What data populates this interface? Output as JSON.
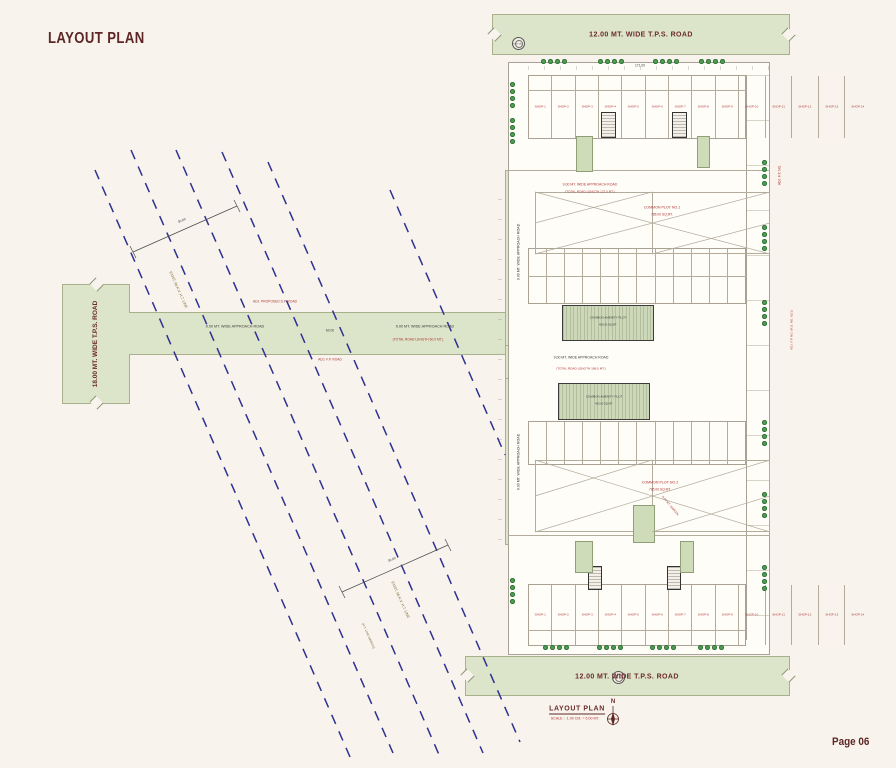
{
  "page": {
    "heading": "LAYOUT PLAN",
    "page_number": "Page 06"
  },
  "title_block": {
    "title": "LAYOUT PLAN",
    "scale": "SCALE :- 1.00 CM. = 5.00 MT.",
    "north_label": "N"
  },
  "roads": {
    "top_tps_road": "12.00 MT. WIDE T.P.S. ROAD",
    "bottom_tps_road": "12.00 MT. WIDE T.P.S. ROAD",
    "left_tps_road": "18.00 MT. WIDE T.P.S. ROAD",
    "approach_road_left": "9.00 MT. WIDE APPROACH ROAD",
    "approach_road_right": "9.00 MT. WIDE APPROACH ROAD",
    "approach_road_vertical_upper": "9.00 MT. WIDE APPROACH ROAD",
    "approach_road_vertical_lower": "9.00 MT. WIDE APPROACH ROAD",
    "approach_road_mid": "9.00 MT. WIDE APPROACH ROAD",
    "approach_road_top_note": "9.00 MT. WIDE APPROACH ROAD",
    "total_length_top": "(TOTAL ROAD LENGTH 127.0 MT.)",
    "total_length_mid": "(TOTAL ROAD LENGTH 186.0 MT.)",
    "total_length_main": "(TOTAL ROAD LENGTH 60.0 MT.)"
  },
  "dimensions": {
    "main_road_span": "60.00",
    "block_width": "171.00",
    "ht_span_1": "30.00",
    "ht_span_2": "30.00"
  },
  "annotations": {
    "adj_road_above": "ADJ. PROPOSED D.P. ROAD",
    "adj_fp_below": "ADJ. F.P. ROAD",
    "adj_fp_right_1": "ADJ. F.P. NO.",
    "adj_fp_right_2": "ADJ. F.P. NO. (R.S. NO. 81/1)",
    "ht_line_1": "EXIST. 66 K.V. H.T. LINE",
    "ht_line_2": "EXIST. 66 K.V. H.T. LINE",
    "ht_margin": "(H.T. LINE MARGIN)",
    "exist_well": "EXIST. WELL",
    "margin_note": "9.00 MT. MARGIN"
  },
  "common_plots": [
    {
      "name": "COMMON PLOT NO.1",
      "area": "785.00 SQ.MT."
    },
    {
      "name": "COMMON PLOT NO.2",
      "area": "785.00 SQ.MT."
    }
  ],
  "amenity_plots": [
    {
      "name": "COMMON AMENITY PLOT",
      "area": "450.00 SQ.MT."
    },
    {
      "name": "COMMON AMENITY PLOT",
      "area": "450.00 SQ.MT."
    }
  ],
  "shops_top": [
    "SHOP-1",
    "SHOP-2",
    "SHOP-3",
    "SHOP-4",
    "SHOP-5",
    "SHOP-6",
    "SHOP-7",
    "SHOP-8",
    "SHOP-9",
    "SHOP-10",
    "SHOP-11",
    "SHOP-12",
    "SHOP-13",
    "SHOP-14"
  ],
  "shops_bottom": [
    "SHOP-1",
    "SHOP-2",
    "SHOP-3",
    "SHOP-4",
    "SHOP-5",
    "SHOP-6",
    "SHOP-7",
    "SHOP-8",
    "SHOP-9",
    "SHOP-10",
    "SHOP-11",
    "SHOP-12",
    "SHOP-13",
    "SHOP-14"
  ],
  "colors": {
    "road_green": "#dce4c9",
    "tree_green": "#4f9d53",
    "maroon": "#5e2626",
    "label_red": "#b03535",
    "ht_line_navy": "#2f3192"
  }
}
